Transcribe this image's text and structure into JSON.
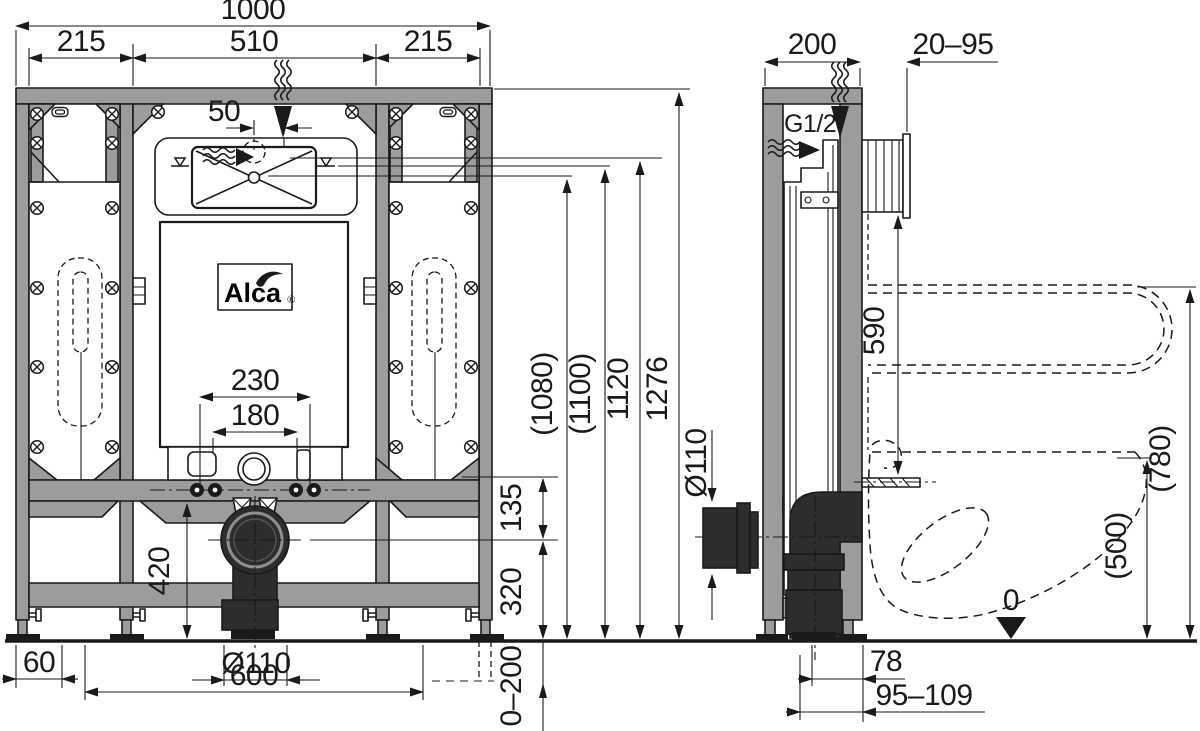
{
  "document_type": "installation-frame technical drawing",
  "brand": {
    "name": "Alca",
    "registered": "®"
  },
  "colors": {
    "line": "#1a1a1a",
    "frame-gray": "#9c9c9c",
    "pipe-dark": "#2b2d2f",
    "bg": "#ffffff"
  },
  "icons": {
    "water_flow": "triple-squiggle with solid arrow",
    "screw": "circle with diagonal cross (phillips screw head)",
    "water_level": "triangle over bar mark",
    "datum_zero": "solid down triangle on floor line",
    "access_opening": "rounded box with X cross"
  },
  "dims": {
    "front": {
      "total_width": "1000",
      "left_section": "215",
      "center_section": "510",
      "right_section": "215",
      "flush_offset": "50",
      "bolt_spacing": "230",
      "bracket_spacing": "180",
      "inlet_height": "(1080)",
      "water_level_height": "(1100)",
      "valve_height": "1120",
      "frame_height": "1276",
      "drain_to_rail": "135",
      "drain_center_height": "320",
      "leg_clearance": "420",
      "wall_offset": "60",
      "drain_diameter": "Ø110",
      "leg_spacing": "600",
      "floor_adjust_range": "0–200"
    },
    "side": {
      "frame_depth": "200",
      "wall_finish_range": "20–95",
      "water_thread": "G1/2\"",
      "flush_to_fixing": "590",
      "support_bar_height": "(780)",
      "seat_height": "(500)",
      "floor_datum": "0",
      "outlet_diameter": "Ø110",
      "outlet_offset": "78",
      "outlet_range": "95–109"
    }
  }
}
